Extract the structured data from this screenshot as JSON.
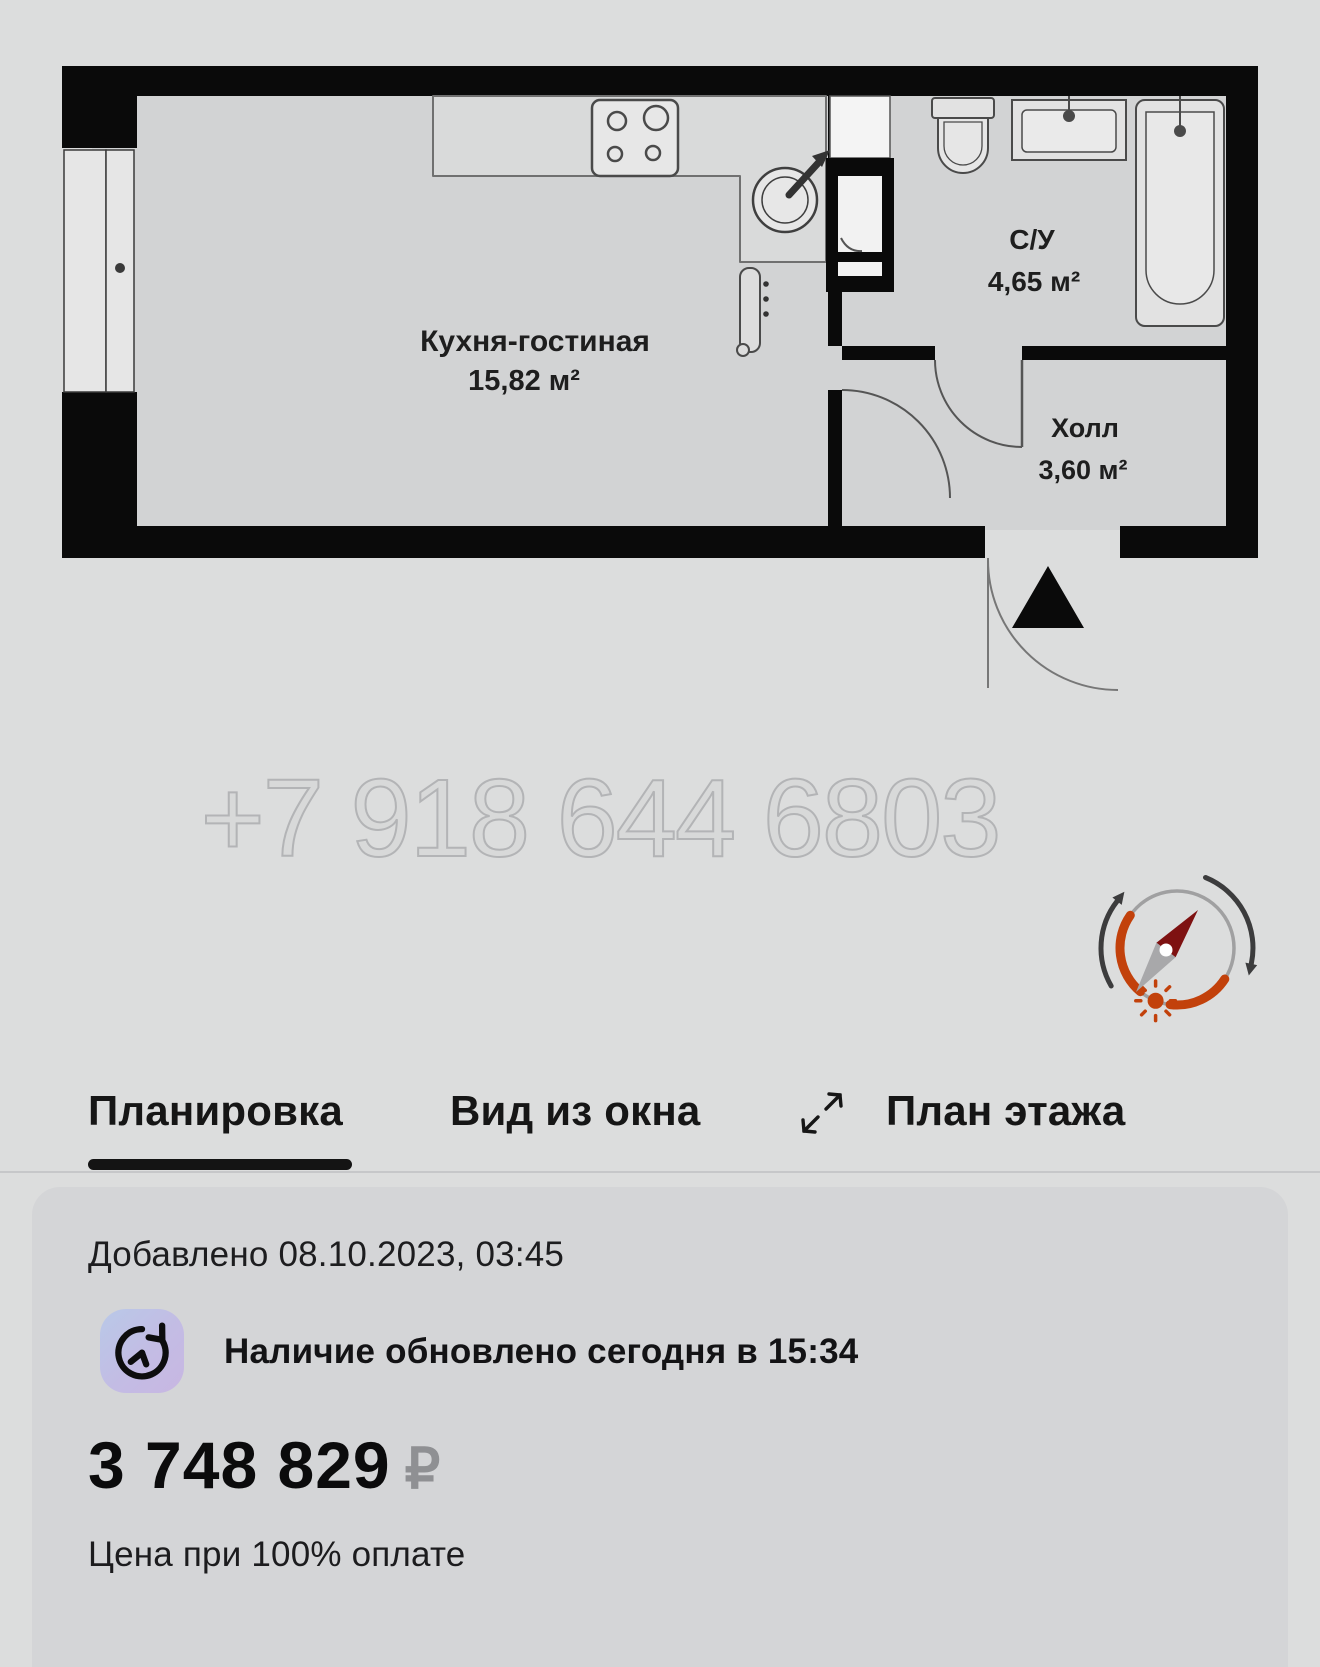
{
  "plan": {
    "rooms": [
      {
        "name": "Кухня-гостиная",
        "area": "15,82 м²"
      },
      {
        "name": "С/У",
        "area": "4,65 м²"
      },
      {
        "name": "Холл",
        "area": "3,60 м²"
      }
    ],
    "watermark": "+7 918 644 6803"
  },
  "tabs": [
    {
      "label": "Планировка",
      "active": true
    },
    {
      "label": "Вид из окна",
      "active": false
    },
    {
      "label": "План этажа",
      "active": false
    }
  ],
  "card": {
    "added_text": "Добавлено 08.10.2023, 03:45",
    "availability_text": "Наличие обновлено сегодня в 15:34",
    "price": "3 748 829",
    "currency": "₽",
    "price_note": "Цена при 100% оплате"
  },
  "colors": {
    "page_bg": "#dcdddd",
    "card_bg": "#d4d5d7",
    "wall_black": "#0a0a0a",
    "accent_orange": "#c2410b",
    "needle_red": "#7e1111",
    "badge_gradient_start": "#b9c9e8",
    "badge_gradient_end": "#c8b7e2"
  }
}
